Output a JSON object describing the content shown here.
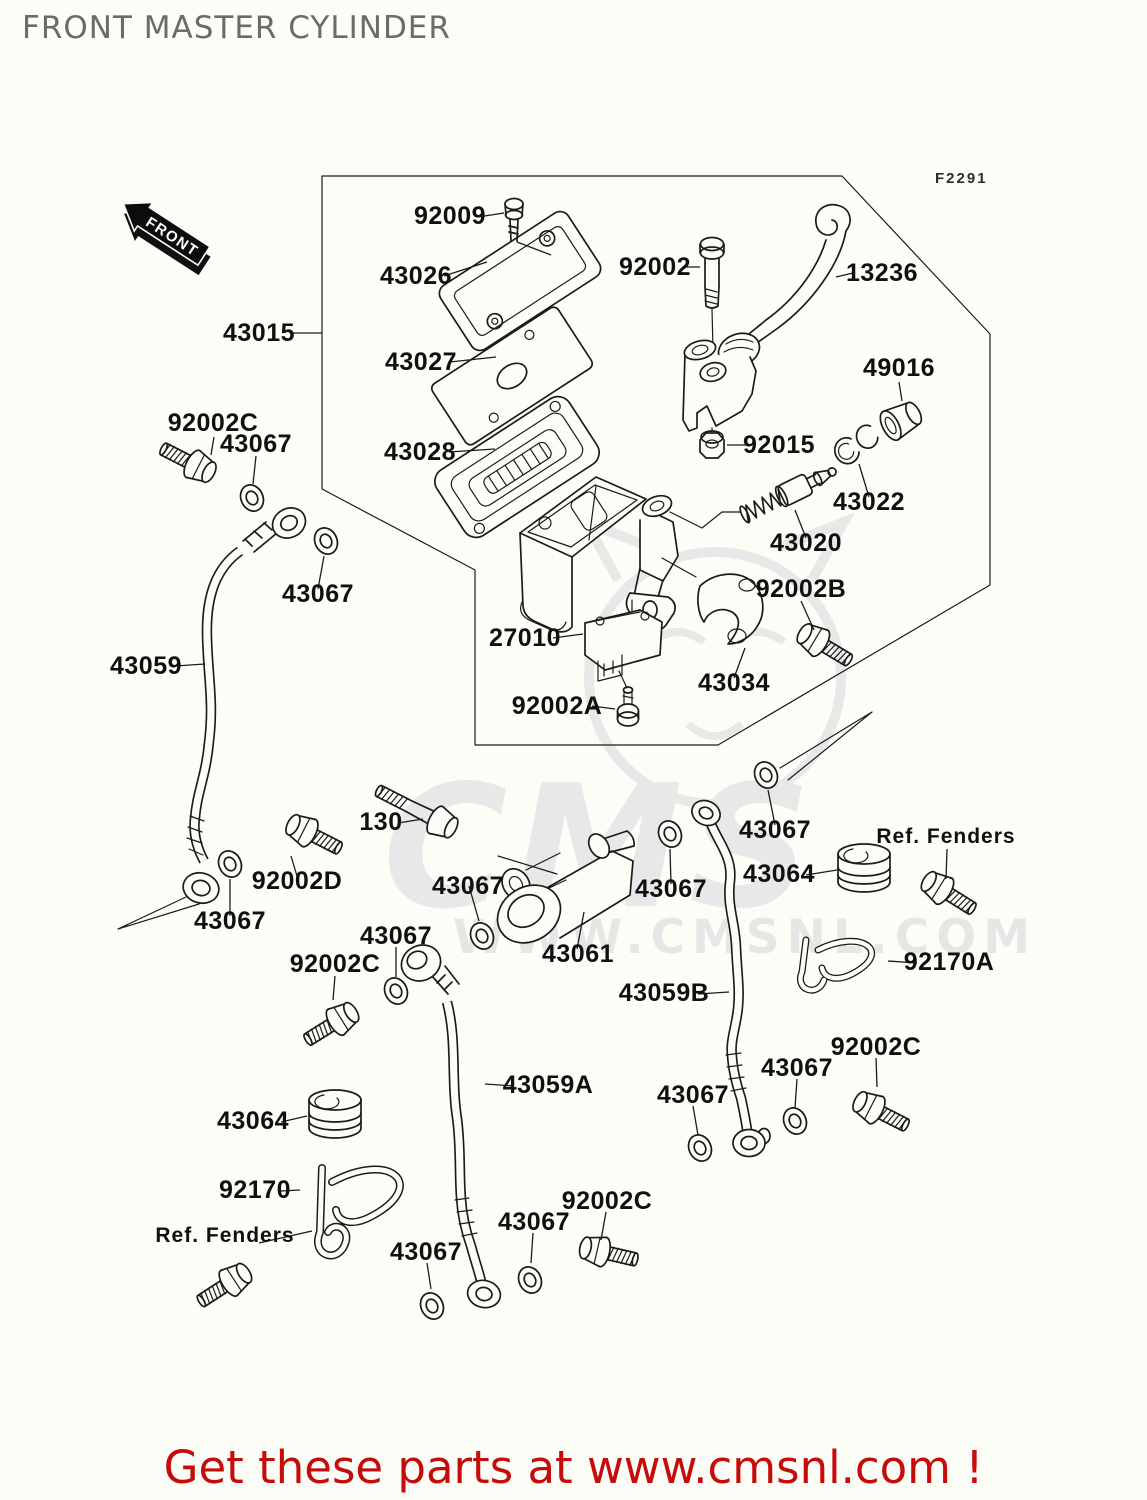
{
  "title": "FRONT MASTER CYLINDER",
  "figure_code": "F2291",
  "front_marker": "FRONT",
  "watermark": {
    "logo": "CMS",
    "url": "WWW.CMSNL.COM"
  },
  "footer": {
    "message": "Get these parts at www.cmsnl.com !"
  },
  "colors": {
    "line": "#1b1b1b",
    "title": "#6b6b6b",
    "footer_red": "#c60b0b",
    "watermark": "#e8e8e8"
  },
  "parts": [
    {
      "label": "92009"
    },
    {
      "label": "43026"
    },
    {
      "label": "92002"
    },
    {
      "label": "13236"
    },
    {
      "label": "43015"
    },
    {
      "label": "43027"
    },
    {
      "label": "49016"
    },
    {
      "label": "92015"
    },
    {
      "label": "43028"
    },
    {
      "label": "43022"
    },
    {
      "label": "92002C"
    },
    {
      "label": "43067"
    },
    {
      "label": "43020"
    },
    {
      "label": "92002B"
    },
    {
      "label": "43067"
    },
    {
      "label": "27010"
    },
    {
      "label": "43059"
    },
    {
      "label": "43034"
    },
    {
      "label": "92002A"
    },
    {
      "label": "43067"
    },
    {
      "label": "Ref. Fenders"
    },
    {
      "label": "130"
    },
    {
      "label": "43064"
    },
    {
      "label": "92002D"
    },
    {
      "label": "43067"
    },
    {
      "label": "43067"
    },
    {
      "label": "43067"
    },
    {
      "label": "43067"
    },
    {
      "label": "92002C"
    },
    {
      "label": "43061"
    },
    {
      "label": "92170A"
    },
    {
      "label": "43059B"
    },
    {
      "label": "43059A"
    },
    {
      "label": "92002C"
    },
    {
      "label": "43067"
    },
    {
      "label": "43067"
    },
    {
      "label": "43064"
    },
    {
      "label": "92170"
    },
    {
      "label": "Ref. Fenders"
    },
    {
      "label": "92002C"
    },
    {
      "label": "43067"
    },
    {
      "label": "43067"
    }
  ]
}
